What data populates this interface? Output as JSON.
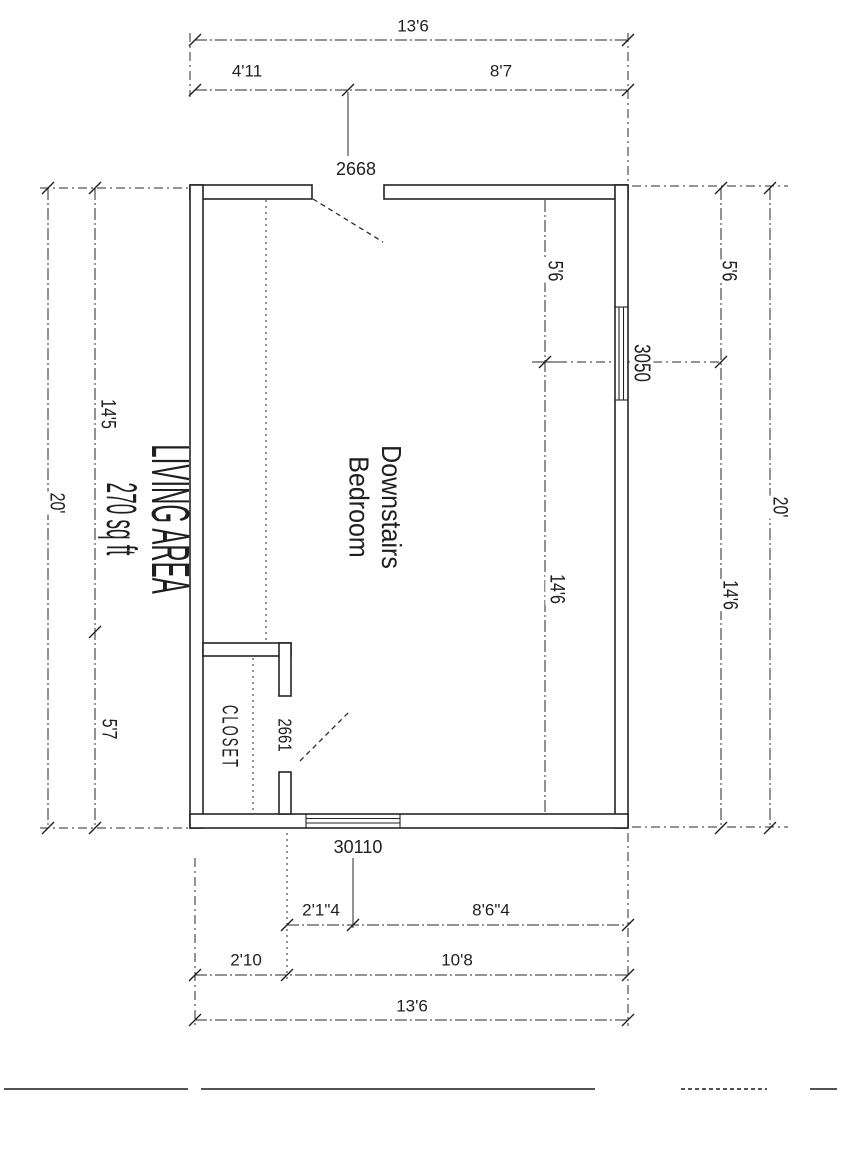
{
  "colors": {
    "ink": "#242424",
    "paper": "#ffffff"
  },
  "plan": {
    "rooms": {
      "living": {
        "name": "LIVING AREA",
        "area": "270 sq ft"
      },
      "bedroom": {
        "name_line1": "Downstairs",
        "name_line2": "Bedroom"
      },
      "closet": {
        "name": "CLOSET"
      }
    },
    "openings": {
      "entry_door_code": "2668",
      "closet_door_code": "2661",
      "right_window_code": "3050",
      "bottom_window_code": "30110"
    },
    "dimensions": {
      "top_overall": "13'6",
      "top_left_segment": "4'11",
      "top_right_segment": "8'7",
      "left_overall": "20'",
      "left_upper_segment": "14'5",
      "left_lower_segment": "5'7",
      "right_inner_upper": "5'6",
      "right_inner_lower": "14'6",
      "right_outer_upper": "5'6",
      "right_outer_lower": "14'6",
      "right_overall": "20'",
      "bottom_window_left": "2'1\"4",
      "bottom_window_right": "8'6\"4",
      "bottom_left_segment": "2'10",
      "bottom_right_segment": "10'8",
      "bottom_overall": "13'6"
    }
  }
}
